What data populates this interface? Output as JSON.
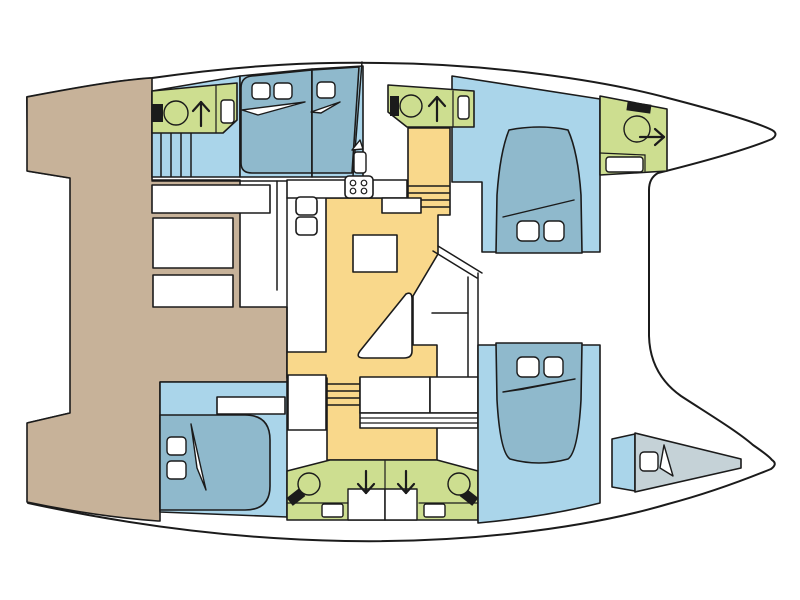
{
  "diagram": {
    "kind": "boat-floor-plan",
    "subject": "catamaran-interior-deck-plan",
    "orientation": "bow-right"
  },
  "colors": {
    "outline": "#1b1b1b",
    "deck": "#ffffff",
    "cockpit": "#c7b299",
    "cabin_floor": "#aad5ea",
    "bed": "#8fb9cc",
    "head": "#cdde90",
    "galley": "#f9d88b",
    "berth": "#c5d2d7",
    "fixture_light": "#ffffff",
    "fixture_dark": "#1b1b1b"
  },
  "areas": {
    "cockpit": "aft-cockpit",
    "salon_galley": "salon-galley",
    "port_aft_head": "port-aft-head",
    "port_companionway": "port-companionway-stairs",
    "port_aft_cabin": "port-aft-cabin",
    "port_mid_berth": "port-mid-berth",
    "port_fwd_head": "port-forward-head",
    "port_fwd_cabin": "port-forward-cabin",
    "bow_head": "forward-bow-head",
    "stb_aft_cabin": "starboard-aft-cabin",
    "stb_heads": "starboard-twin-heads",
    "stb_fwd_cabin": "starboard-forward-cabin",
    "skipper_berth": "bow-skipper-berth"
  },
  "icons": {
    "toilet": "toilet-icon",
    "shower_up": "shower-arrow-up-icon",
    "shower_down": "shower-arrow-down-icon",
    "shower_right": "shower-arrow-right-icon",
    "sink": "sink-icon",
    "stove": "stove-icon",
    "stairs": "stairs-icon",
    "pillow": "pillow-icon",
    "sheet_fold": "sheet-fold-icon"
  }
}
